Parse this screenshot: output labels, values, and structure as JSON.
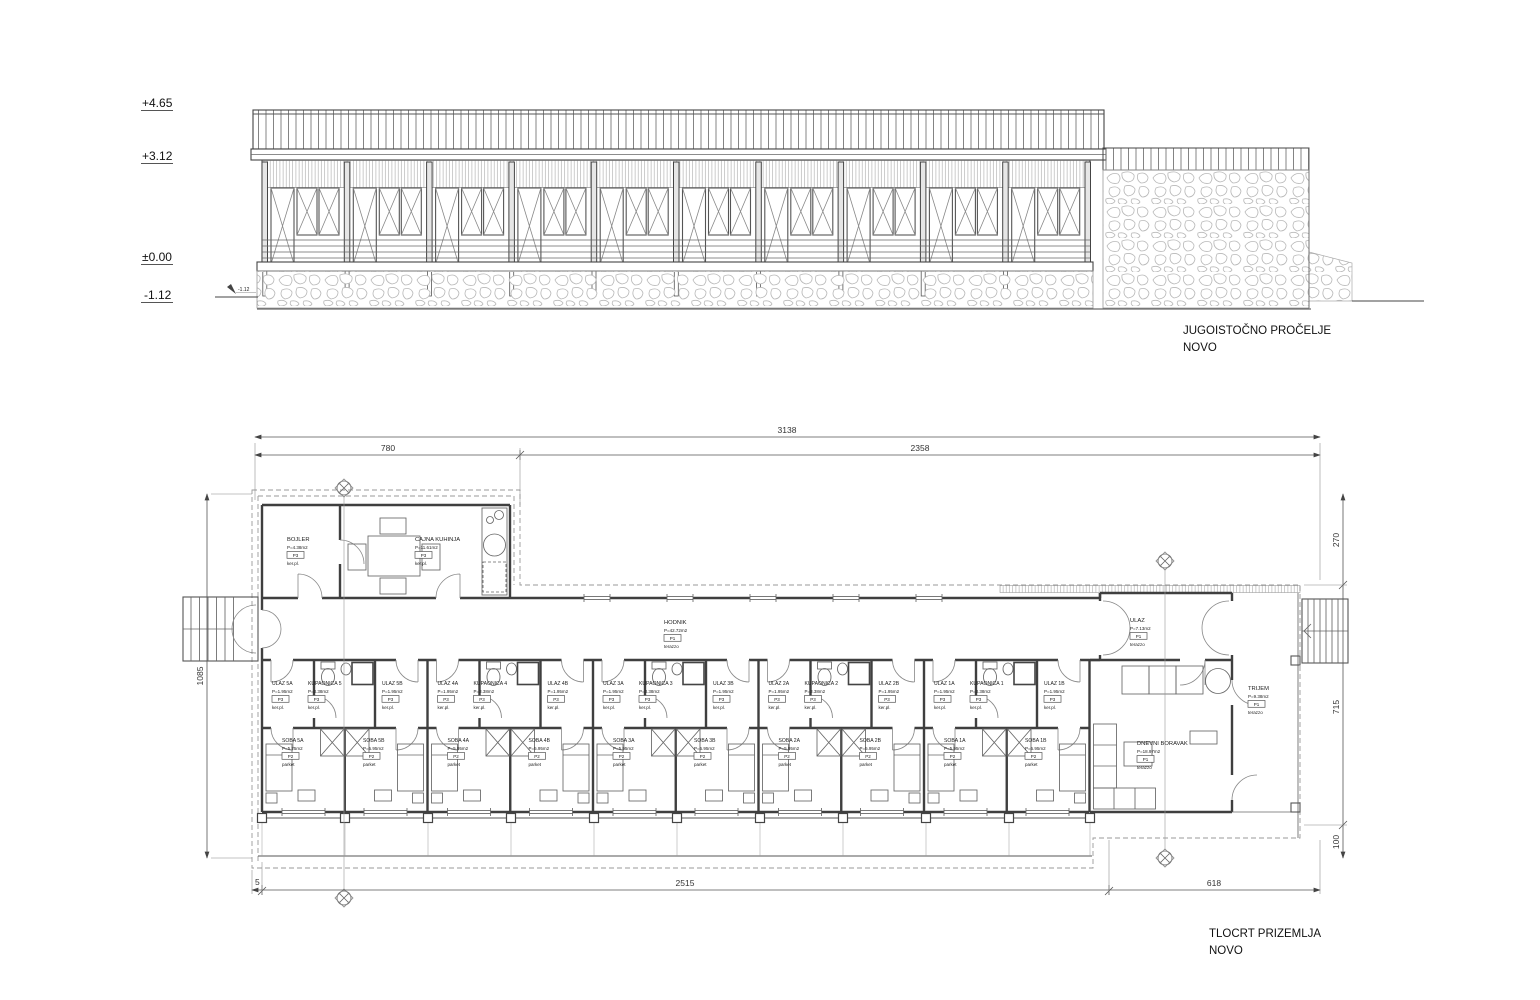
{
  "elevation": {
    "levels": [
      {
        "label": "+4.65"
      },
      {
        "label": "+3.12"
      },
      {
        "label": "±0.00"
      },
      {
        "label": "-1.12"
      }
    ],
    "ground_mark": "-1.12",
    "title": "JUGOISTOČNO PROČELJE",
    "subtitle": "NOVO"
  },
  "plan": {
    "title": "TLOCRT PRIZEMLJA",
    "subtitle": "NOVO",
    "dims": {
      "total": "3138",
      "left_span": "780",
      "right_span": "2358",
      "height": "1085",
      "right_top": "270",
      "right_mid": "715",
      "right_bot": "100",
      "bottom_small": "5",
      "bottom_main": "2515",
      "bottom_right": "618"
    },
    "rooms": {
      "bojler": {
        "name": "BOJLER",
        "area": "P=4.38m2",
        "code": "P3",
        "floor": "ker.pl."
      },
      "cajna_kuhinja": {
        "name": "CAJNA KUHINJA",
        "area": "P=11.61m2",
        "code": "P3",
        "floor": "ker.pl."
      },
      "hodnik": {
        "name": "HODNIK",
        "area": "P=42.72m2",
        "code": "P1",
        "floor": "terazzo"
      },
      "ulaz": {
        "name": "ULAZ",
        "area": "P=7.13m2",
        "code": "P1",
        "floor": "terazzo"
      },
      "trijem": {
        "name": "TRIJEM",
        "area": "P=9.38m2",
        "code": "P1",
        "floor": "terazzo"
      },
      "dnevni_boravak": {
        "name": "DNEVNI BORAVAK",
        "area": "P=18.97m2",
        "code": "P1",
        "floor": "terazzo"
      }
    },
    "modules": [
      {
        "ulaz_a": {
          "name": "ULAZ 5A",
          "area": "P=1.95m2",
          "code": "P3",
          "floor": "ker.pl."
        },
        "kupaonica": {
          "name": "KUPAONICA 5",
          "area": "P=3.38m2",
          "code": "P3",
          "floor": "ker.pl."
        },
        "ulaz_b": {
          "name": "ULAZ 5B",
          "area": "P=1.95m2",
          "code": "P3",
          "floor": "ker.pl."
        },
        "soba_a": {
          "name": "SOBA 5A",
          "area": "P=5.75m2",
          "code": "P2",
          "floor": "parket"
        },
        "soba_b": {
          "name": "SOBA 5B",
          "area": "P=5.95m2",
          "code": "P2",
          "floor": "parket"
        }
      },
      {
        "ulaz_a": {
          "name": "ULAZ 4A",
          "area": "P=1.95m2",
          "code": "P3",
          "floor": "ker.pl."
        },
        "kupaonica": {
          "name": "KUPAONICA 4",
          "area": "P=3.38m2",
          "code": "P3",
          "floor": "ker.pl."
        },
        "ulaz_b": {
          "name": "ULAZ 4B",
          "area": "P=1.95m2",
          "code": "P3",
          "floor": "ker.pl."
        },
        "soba_a": {
          "name": "SOBA 4A",
          "area": "P=5.95m2",
          "code": "P2",
          "floor": "parket"
        },
        "soba_b": {
          "name": "SOBA 4B",
          "area": "P=5.95m2",
          "code": "P2",
          "floor": "parket"
        }
      },
      {
        "ulaz_a": {
          "name": "ULAZ 3A",
          "area": "P=1.95m2",
          "code": "P3",
          "floor": "ker.pl."
        },
        "kupaonica": {
          "name": "KUPAONICA 3",
          "area": "P=3.38m2",
          "code": "P3",
          "floor": "ker.pl."
        },
        "ulaz_b": {
          "name": "ULAZ 3B",
          "area": "P=1.95m2",
          "code": "P3",
          "floor": "ker.pl."
        },
        "soba_a": {
          "name": "SOBA 3A",
          "area": "P=5.95m2",
          "code": "P2",
          "floor": "parket"
        },
        "soba_b": {
          "name": "SOBA 3B",
          "area": "P=5.95m2",
          "code": "P2",
          "floor": "parket"
        }
      },
      {
        "ulaz_a": {
          "name": "ULAZ 2A",
          "area": "P=1.95m2",
          "code": "P3",
          "floor": "ker.pl."
        },
        "kupaonica": {
          "name": "KUPAONICA 2",
          "area": "P=3.38m2",
          "code": "P3",
          "floor": "ker.pl."
        },
        "ulaz_b": {
          "name": "ULAZ 2B",
          "area": "P=1.95m2",
          "code": "P3",
          "floor": "ker.pl."
        },
        "soba_a": {
          "name": "SOBA 2A",
          "area": "P=5.95m2",
          "code": "P2",
          "floor": "parket"
        },
        "soba_b": {
          "name": "SOBA 2B",
          "area": "P=5.95m2",
          "code": "P2",
          "floor": "parket"
        }
      },
      {
        "ulaz_a": {
          "name": "ULAZ 1A",
          "area": "P=1.95m2",
          "code": "P3",
          "floor": "ker.pl."
        },
        "kupaonica": {
          "name": "KUPAONICA 1",
          "area": "P=3.38m2",
          "code": "P3",
          "floor": "ker.pl."
        },
        "ulaz_b": {
          "name": "ULAZ 1B",
          "area": "P=1.95m2",
          "code": "P3",
          "floor": "ker.pl."
        },
        "soba_a": {
          "name": "SOBA 1A",
          "area": "P=5.95m2",
          "code": "P2",
          "floor": "parket"
        },
        "soba_b": {
          "name": "SOBA 1B",
          "area": "P=5.95m2",
          "code": "P2",
          "floor": "parket"
        }
      }
    ]
  }
}
